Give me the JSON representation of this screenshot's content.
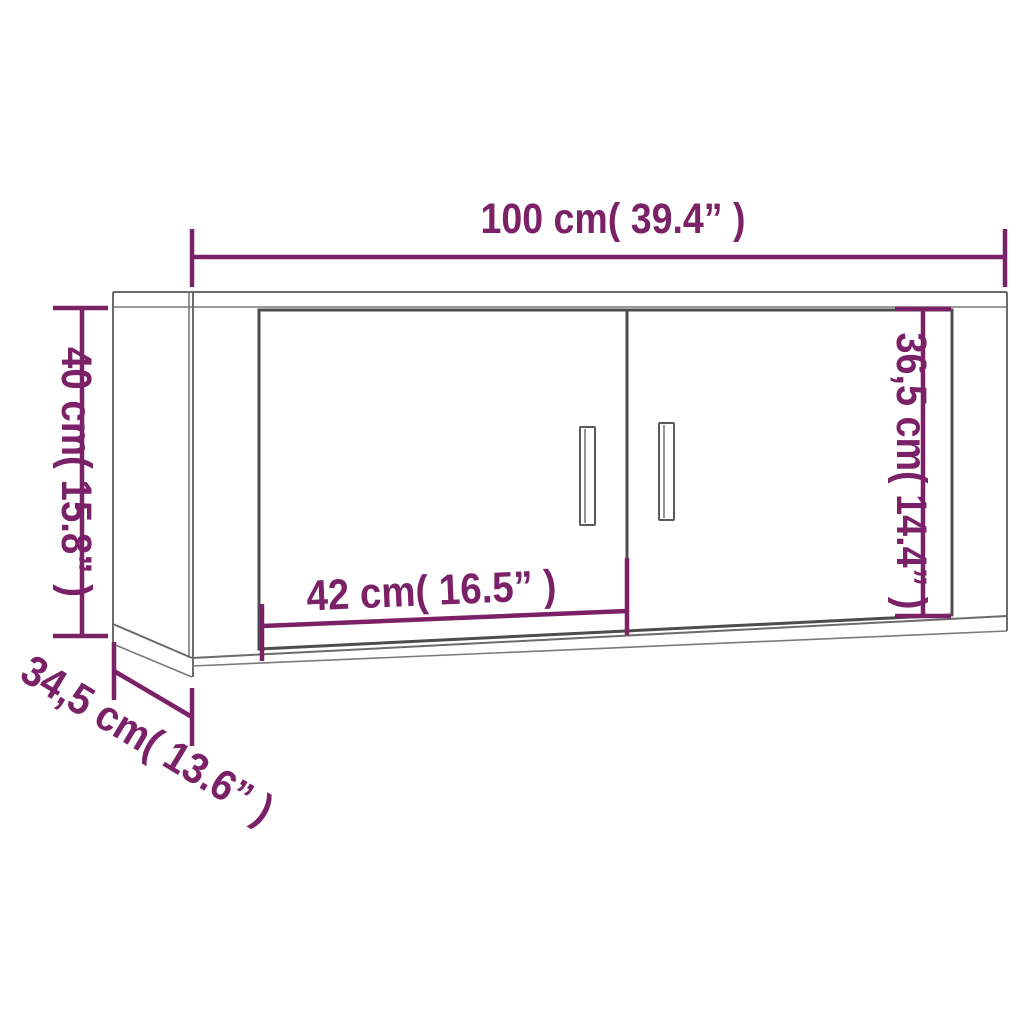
{
  "diagram": {
    "title": "wall-cabinet-dimension-diagram",
    "colors": {
      "dimension_accent": "#7B2168",
      "outline_gray": "#6b6b6b",
      "door_outline_gray": "#4d4d4d",
      "background": "#ffffff"
    },
    "dimensions": [
      {
        "id": "overall_width",
        "label": "100 cm( 39.4” )",
        "cm": "100",
        "inch": "39.4"
      },
      {
        "id": "overall_height",
        "label": "40 cm( 15.8” )",
        "cm": "40",
        "inch": "15.8"
      },
      {
        "id": "overall_depth",
        "label": "34,5 cm( 13.6” )",
        "cm": "34,5",
        "inch": "13.6"
      },
      {
        "id": "door_width",
        "label": "42 cm( 16.5” )",
        "cm": "42",
        "inch": "16.5"
      },
      {
        "id": "door_height",
        "label": "36,5 cm( 14.4” )",
        "cm": "36,5",
        "inch": "14.4"
      }
    ]
  }
}
